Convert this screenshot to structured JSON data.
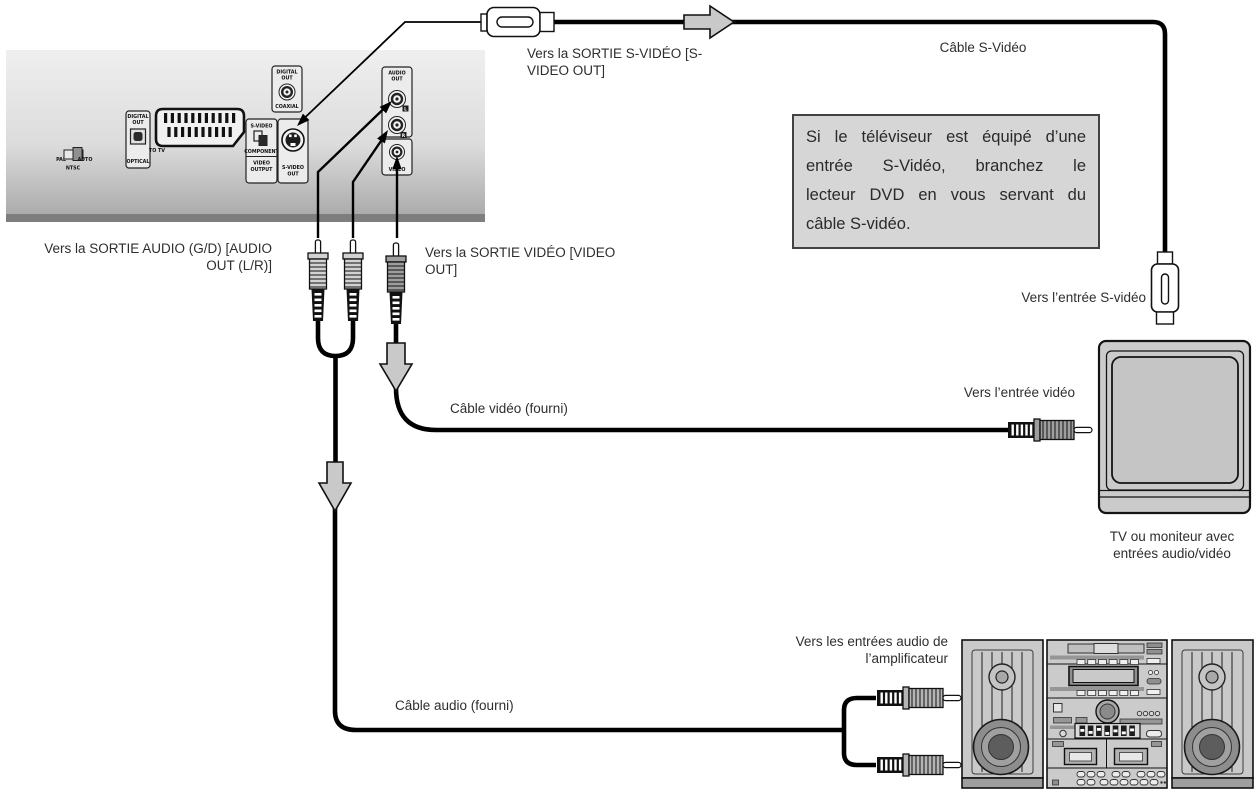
{
  "colors": {
    "cable": "#000000",
    "block_arrow_fill": "#c9c9c9",
    "info_box_bg": "#d6d6d6",
    "panel_top": "#efefef",
    "panel_bottom": "#a6a6a6",
    "equipment_fill": "#c9c9c9",
    "text": "#2e2e2e"
  },
  "dvd_panel": {
    "switch": {
      "pal": "PAL",
      "auto": "AUTO",
      "ntsc": "NTSC"
    },
    "digital_out_optical": {
      "title_line1": "DIGITAL",
      "title_line2": "OUT",
      "port": "OPTICAL"
    },
    "scart": {
      "label": "TO TV"
    },
    "component_output": {
      "top": "S-VIDEO",
      "mid": "COMPONENT",
      "bottom_line1": "VIDEO",
      "bottom_line2": "OUTPUT"
    },
    "s_video_out": {
      "line1": "S-VIDEO",
      "line2": "OUT"
    },
    "digital_out_coaxial": {
      "title_line1": "DIGITAL",
      "title_line2": "OUT",
      "port": "COAXIAL"
    },
    "audio_out": {
      "title_line1": "AUDIO",
      "title_line2": "OUT",
      "jack_left": "L",
      "jack_right": "R"
    },
    "video_jack": {
      "label": "VIDEO"
    }
  },
  "labels": {
    "to_s_video_out": "Vers la SORTIE S-VIDÉO [S-\nVIDEO OUT]",
    "s_video_cable": "Câble S-Vidéo",
    "to_audio_out": "Vers la SORTIE AUDIO (G/D) [AUDIO\nOUT (L/R)]",
    "to_video_out": "Vers la SORTIE VIDÉO [VIDEO\nOUT]",
    "to_s_video_input": "Vers l’entrée S-vidéo",
    "to_video_input": "Vers l’entrée vidéo",
    "video_cable": "Câble vidéo (fourni)",
    "tv_caption": "TV ou moniteur avec\nentrées audio/vidéo",
    "to_amplifier_audio_inputs": "Vers les entrées audio de\nl’amplificateur",
    "audio_cable": "Câble audio (fourni)"
  },
  "info_box": {
    "lines": [
      "Si le téléviseur est équipé d’une",
      "entrée S-Vidéo, branchez le",
      "lecteur DVD en vous servant du",
      "câble S-vidéo."
    ]
  }
}
